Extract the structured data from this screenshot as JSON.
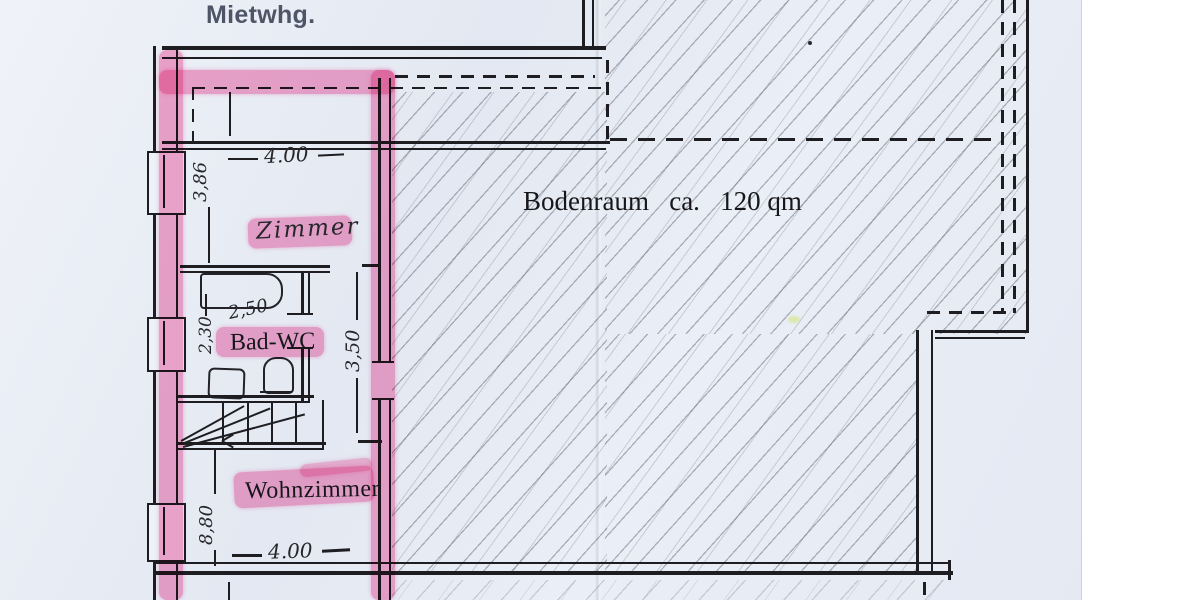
{
  "page": {
    "annotation": "Mietwhg.",
    "annotation_color": "#4d5566",
    "highlight_color": "#f658a0",
    "paper_color": "#e9edf5",
    "ink_color": "#1e1e22"
  },
  "plan": {
    "attic_label": "Bodenraum   ca.   120 qm",
    "rooms": [
      {
        "name": "Zimmer"
      },
      {
        "name": "Bad-WC"
      },
      {
        "name": "Wohnzimmer"
      }
    ],
    "dims": {
      "zimmer_width_top": "4.00",
      "zimmer_depth": "3,86",
      "bad_width": "2,50",
      "bad_depth": "2,30",
      "mid_depth": "3,50",
      "lower_depth": "8,80",
      "wohnzimmer_width_bottom": "4.00"
    }
  }
}
